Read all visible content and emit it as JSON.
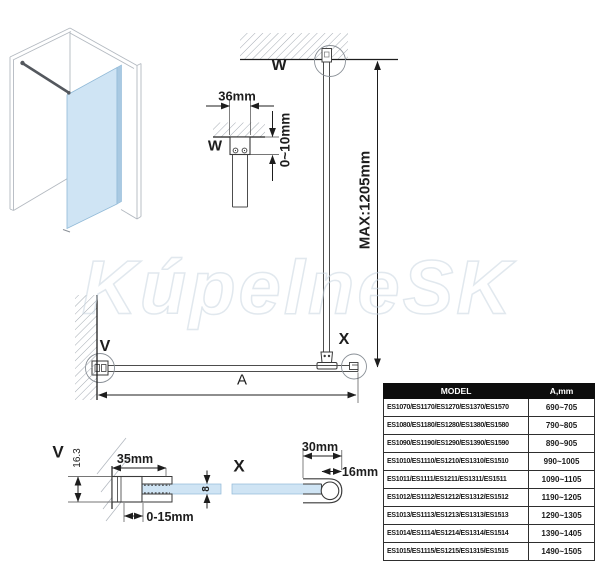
{
  "watermark": "KúpelneSK",
  "colors": {
    "glass": "#cfe4f4",
    "glass_edge": "#a9c9e2",
    "line_dark": "#1d1d1d",
    "line_gray": "#9aa2ab",
    "table_header_bg": "#0d0d0d",
    "table_header_text": "#ffffff"
  },
  "diagram": {
    "front_view": {
      "ceiling_connector_label": "W",
      "wall_connector_label": "V",
      "glass_connector_label": "X",
      "width_dim": "A",
      "bar_max_length": "MAX:1205mm"
    },
    "detail_w": {
      "label": "W",
      "profile_width": "36mm",
      "ceiling_gap": "0~10mm"
    },
    "detail_v": {
      "label": "V",
      "profile_height": "16.3",
      "profile_depth": "35mm",
      "glass_adjust": "0-15mm"
    },
    "detail_x": {
      "label": "X",
      "holder_width": "30mm",
      "bar_diameter": "16mm",
      "glass_thickness": "8"
    }
  },
  "table": {
    "headers": [
      "MODEL",
      "A,mm"
    ],
    "rows": [
      {
        "model": "ES1070/ES1170/ES1270/ES1370/ES1570",
        "a_mm": "690~705"
      },
      {
        "model": "ES1080/ES1180/ES1280/ES1380/ES1580",
        "a_mm": "790~805"
      },
      {
        "model": "ES1090/ES1190/ES1290/ES1390/ES1590",
        "a_mm": "890~905"
      },
      {
        "model": "ES1010/ES1110/ES1210/ES1310/ES1510",
        "a_mm": "990~1005"
      },
      {
        "model": "ES1011/ES1111/ES1211/ES1311/ES1511",
        "a_mm": "1090~1105"
      },
      {
        "model": "ES1012/ES1112/ES1212/ES1312/ES1512",
        "a_mm": "1190~1205"
      },
      {
        "model": "ES1013/ES1113/ES1213/ES1313/ES1513",
        "a_mm": "1290~1305"
      },
      {
        "model": "ES1014/ES1114/ES1214/ES1314/ES1514",
        "a_mm": "1390~1405"
      },
      {
        "model": "ES1015/ES1115/ES1215/ES1315/ES1515",
        "a_mm": "1490~1505"
      }
    ]
  }
}
